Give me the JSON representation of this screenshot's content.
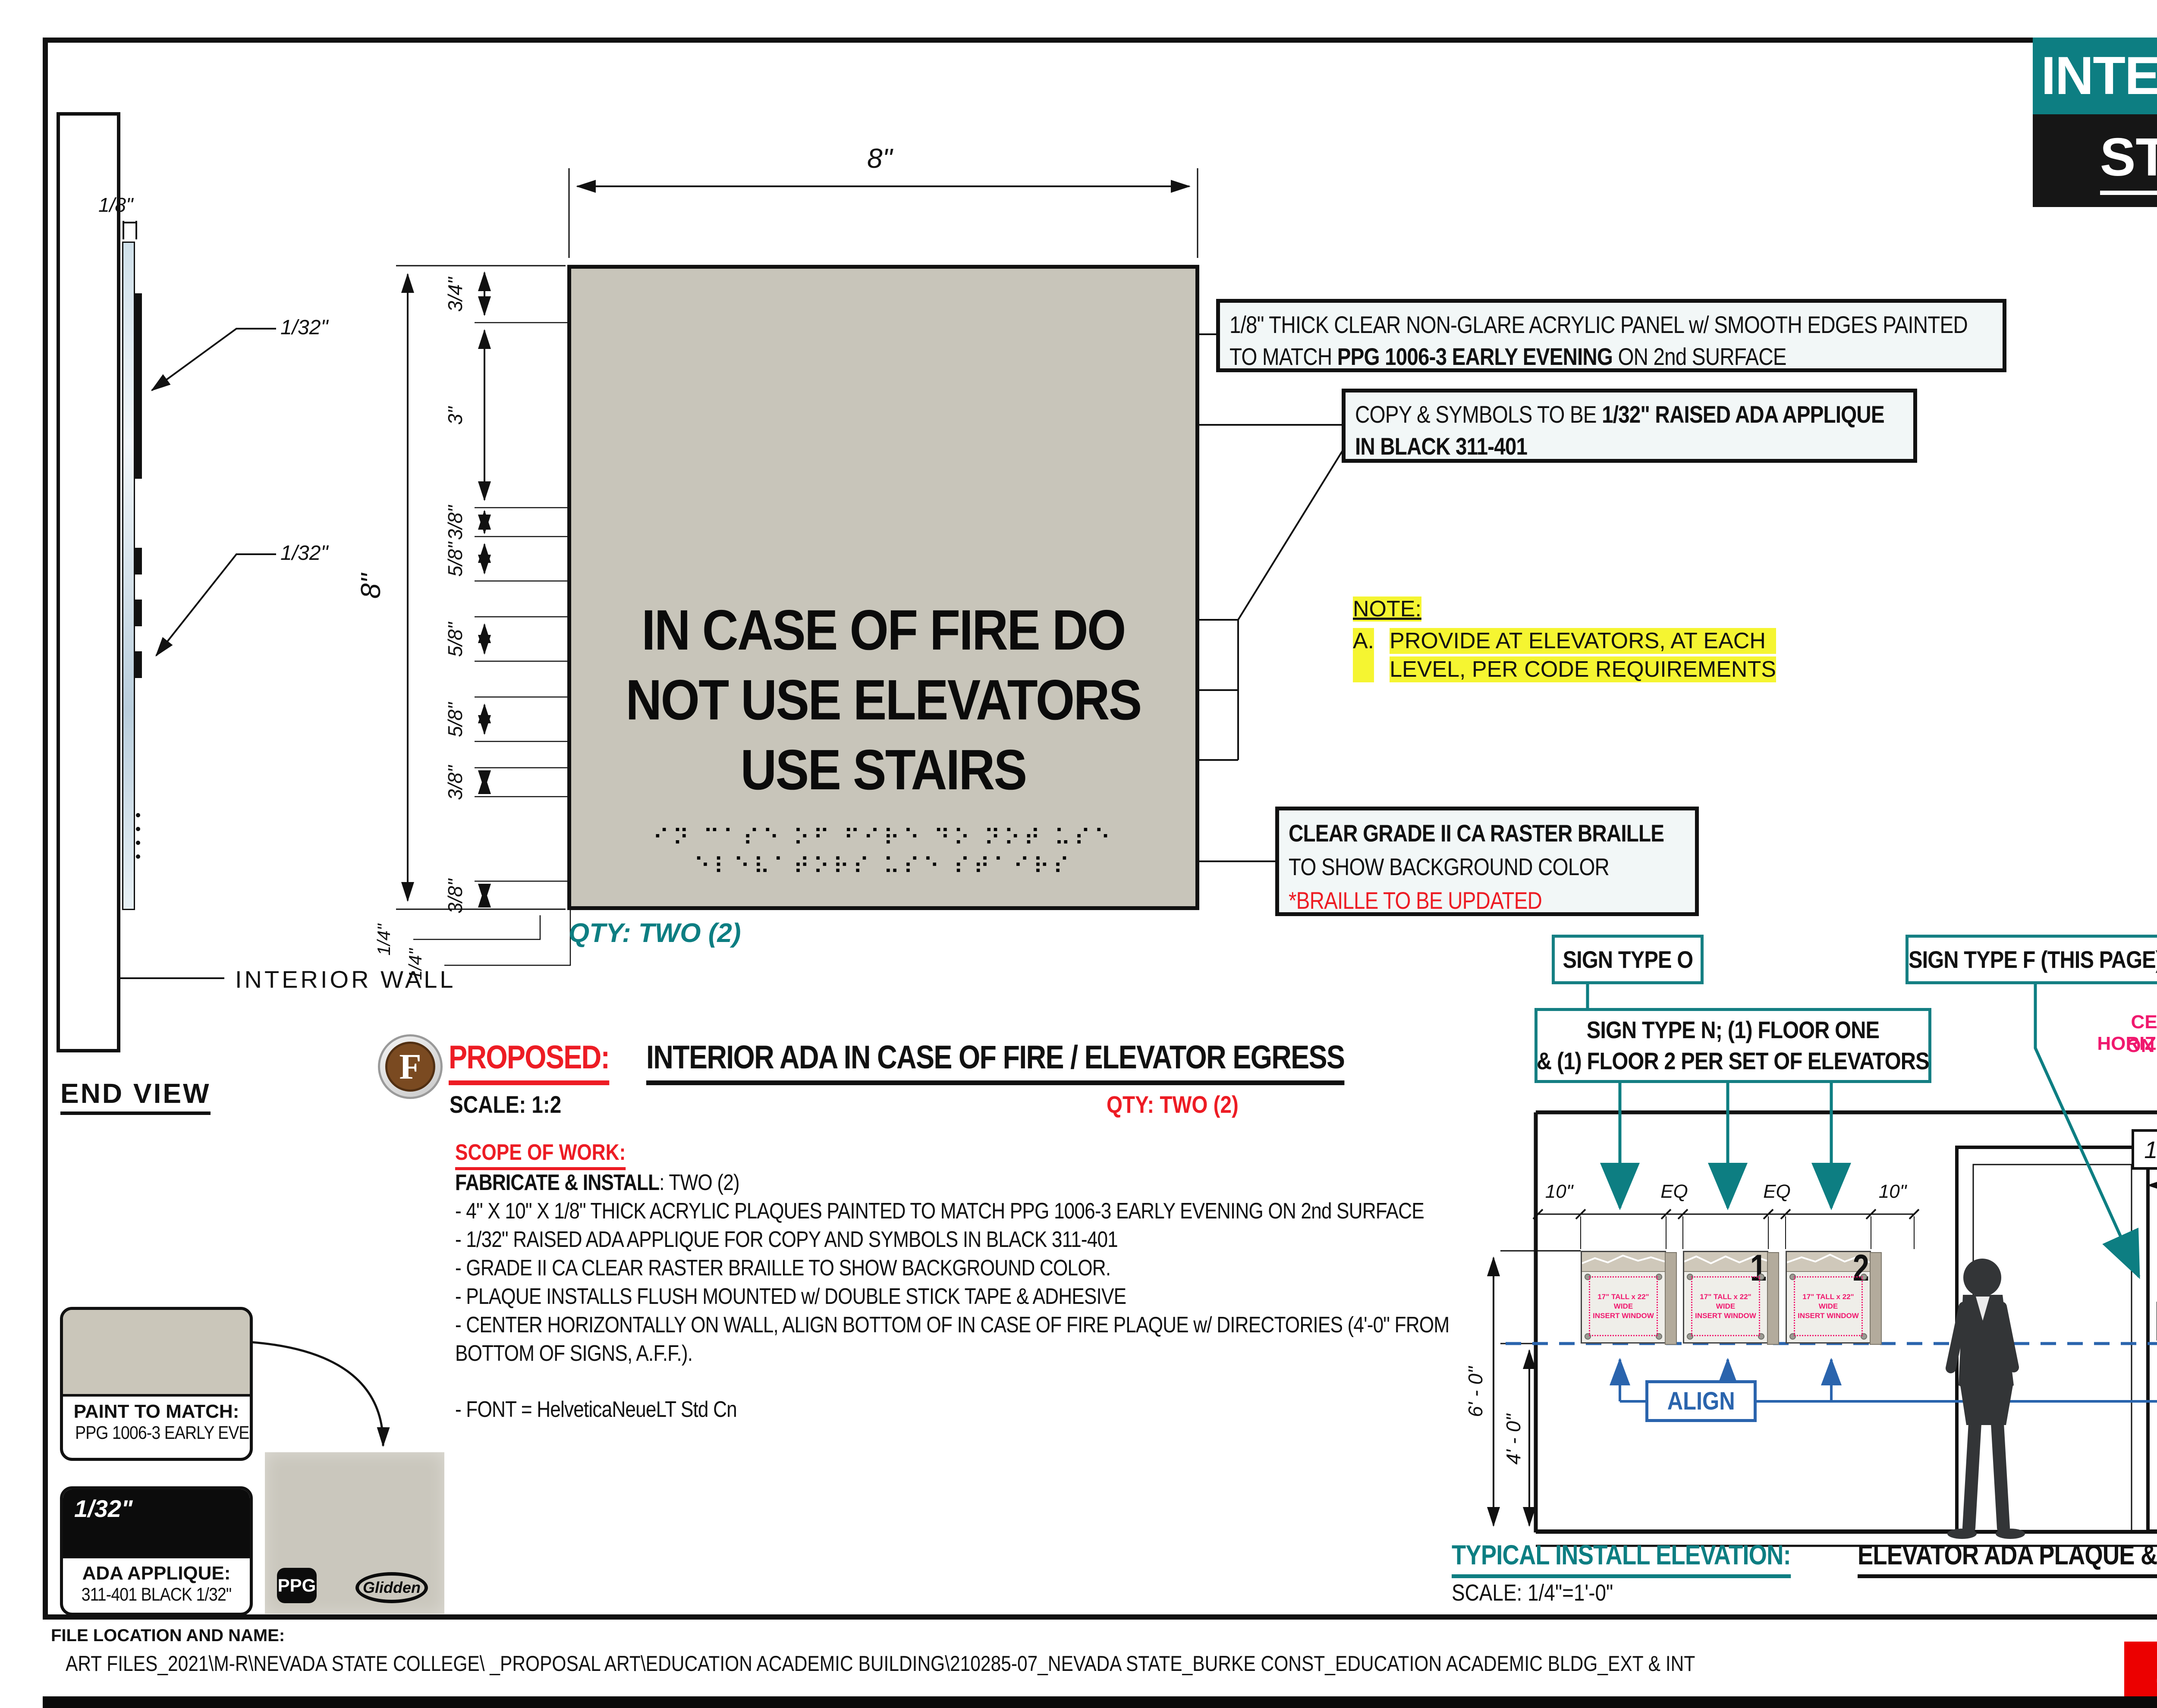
{
  "title_block": {
    "category": "INTERIOR",
    "sign_type_prefix": "ST:",
    "sign_type_value": "H"
  },
  "sidebar": {
    "company_label": "COMPANY NAME:",
    "logo_n": "N",
    "logo_s": "S",
    "logo_name": "NEVADA STATE",
    "logo_sub": "C O L L E G E",
    "address_line1": "1125 NEVADA STATE COLLEGE DR",
    "address_line2": "HENDERSON, NV 89002",
    "client_approval_label": "CLIENT APPROVAL:",
    "approval_date_label": "APPROVAL DATE:",
    "salesperson_label": "SALESPERSON:"
  },
  "end_view": {
    "label": "END VIEW",
    "wall_label": "INTERIOR WALL",
    "dim_thickness": "1/8\"",
    "dim_applique1": "1/32\"",
    "dim_applique2": "1/32\""
  },
  "sign": {
    "line1": "IN CASE OF FIRE DO",
    "line2": "NOT USE ELEVATORS",
    "line3": "USE STAIRS",
    "braille_row1": "⠊⠝ ⠉⠁⠎⠑ ⠕⠋ ⠋⠊⠗⠑ ⠙⠕ ⠝⠕⠞ ⠥⠎⠑",
    "braille_row2": "⠑⠇⠑⠧⠁⠞⠕⠗⠎ ⠥⠎⠑ ⠎⠞⠁⠊⠗⠎",
    "qty": "QTY: TWO (2)",
    "dim_width": "8\"",
    "dim_height": "8\"",
    "left_chain": [
      "3/4\"",
      "3\"",
      "3/8\"",
      "5/8\"",
      "5/8\"",
      "5/8\"",
      "3/8\"",
      "3/8\""
    ],
    "quarter_dims": [
      "1/4\"",
      "1/4\""
    ]
  },
  "callouts": {
    "panel_line1": "1/8\" THICK CLEAR NON-GLARE ACRYLIC PANEL w/ SMOOTH EDGES PAINTED",
    "panel_line2_pre": "TO MATCH ",
    "panel_line2_bold": "PPG 1006-3 EARLY EVENING",
    "panel_line2_post": " ON 2nd SURFACE",
    "copy_line1_pre": "COPY & SYMBOLS TO BE ",
    "copy_line1_bold": "1/32\" RAISED ADA APPLIQUE",
    "copy_line2_bold": "IN BLACK 311-401",
    "braille_line1": "CLEAR GRADE II CA RASTER BRAILLE",
    "braille_line2": "TO SHOW BACKGROUND COLOR",
    "braille_line3": "*BRAILLE TO BE UPDATED"
  },
  "note": {
    "label": "NOTE:",
    "item_letter": "A.",
    "item_line1": "PROVIDE AT ELEVATORS, AT EACH",
    "item_line2": "LEVEL, PER CODE REQUIREMENTS"
  },
  "proposal": {
    "badge": "F",
    "label": "PROPOSED:",
    "title": "INTERIOR ADA IN CASE OF FIRE / ELEVATOR EGRESS",
    "scale": "SCALE: 1:2",
    "qty": "QTY: TWO (2)",
    "scope_label": "SCOPE OF WORK:",
    "scope_intro_bold": "FABRICATE & INSTALL",
    "scope_intro_rest": ": TWO (2)",
    "scope_items": [
      "- 4\" X 10\" X 1/8\" THICK ACRYLIC PLAQUES PAINTED TO MATCH PPG 1006-3 EARLY EVENING ON 2nd SURFACE",
      "- 1/32\" RAISED ADA APPLIQUE FOR COPY AND SYMBOLS IN BLACK 311-401",
      "- GRADE II CA CLEAR RASTER BRAILLE TO SHOW BACKGROUND COLOR.",
      "- PLAQUE INSTALLS FLUSH MOUNTED w/ DOUBLE STICK TAPE & ADHESIVE",
      "- CENTER HORIZONTALLY ON WALL, ALIGN BOTTOM OF IN CASE OF FIRE PLAQUE w/ DIRECTORIES (4'-0\" FROM",
      "BOTTOM OF SIGNS, A.F.F.)."
    ],
    "font_note": "- FONT  = HelveticaNeueLT Std Cn"
  },
  "swatches": {
    "paint_label": "PAINT TO MATCH:",
    "paint_value": "PPG 1006-3 EARLY EVENING",
    "applique_dim": "1/32\"",
    "applique_label": "ADA APPLIQUE:",
    "applique_value": "311-401 BLACK 1/32\"",
    "ppg_logo": "PPG",
    "glidden_logo": "Glidden"
  },
  "elevation": {
    "label_o": "SIGN TYPE O",
    "label_f": "SIGN TYPE F (THIS PAGE)",
    "label_n_line1": "SIGN TYPE N; (1) FLOOR ONE",
    "label_n_line2": "& (1) FLOOR 2 PER SET OF ELEVATORS",
    "center_note_line1": "CENTER HORIZONTALLY",
    "center_note_line2": "ON WALL",
    "centerline_symbol": "℄",
    "dim_1_8": "1'-8\"",
    "top_dims": [
      "10\"",
      "EQ",
      "EQ",
      "10\""
    ],
    "dim_6_0": "6' - 0\"",
    "dim_4_0_left": "4' - 0\"",
    "dim_4_0_right": "4'-0\"",
    "align_label": "ALIGN",
    "plaque_insert_line1": "17\" TALL x 22\" WIDE",
    "plaque_insert_line2": "INSERT WINDOW",
    "plaque_no_1": "1",
    "plaque_no_2": "2",
    "mini_sign_line1": "IN CASE OF FIRE DO",
    "mini_sign_line2": "NOT USE ELEVATORS",
    "mini_sign_line3": "USE STAIRS",
    "mini_sign_braille": "⠿⠿⠿",
    "title_teal": "TYPICAL INSTALL ELEVATION:",
    "title_black": "ELEVATOR ADA PLAQUE & DIRECTORIES",
    "scale": "SCALE: 1/4\"=1'-0\""
  },
  "footer": {
    "label": "FILE LOCATION AND NAME:",
    "path": "ART FILES_2021\\M-R\\NEVADA STATE COLLEGE\\ _PROPOSAL ART\\EDUCATION ACADEMIC BUILDING\\210285-07_NEVADA STATE_BURKE CONST_EDUCATION ACADEMIC BLDG_EXT & INT",
    "job_number": "210285"
  },
  "colors": {
    "teal": "#0d7e82",
    "red": "#ed1c24",
    "pink": "#f0186e",
    "blue": "#2a64ad",
    "yellow_highlight": "#f5f531",
    "sign_gray": "#c8c5ba",
    "badge_brown": "#7a4a21",
    "job_red": "#ec0000"
  }
}
